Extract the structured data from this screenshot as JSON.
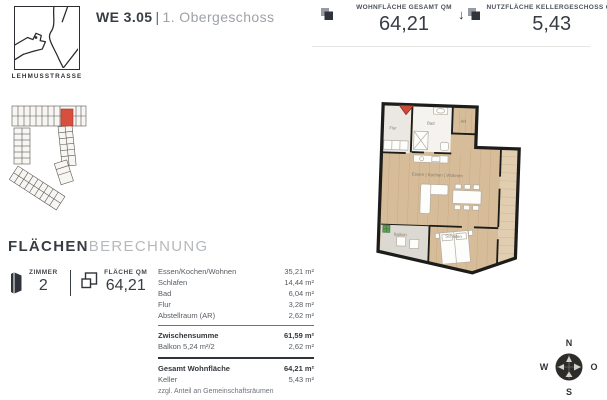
{
  "header": {
    "logo": {
      "caption": "LEHMUSSTRASSE",
      "icon": "street-map-icon"
    },
    "title": {
      "unit": "WE 3.05",
      "divider": "|",
      "floor": "1. Obergeschoss"
    },
    "stats": [
      {
        "icon": "overlapping-squares-icon",
        "label": "WOHNFLÄCHE GESAMT QM",
        "value": "64,21"
      },
      {
        "icon": "overlapping-squares-icon",
        "arrow": "↓",
        "label": "NUTZFLÄCHE KELLERGESCHOSS QM",
        "value": "5,43"
      }
    ]
  },
  "section": {
    "title_bold": "FLÄCHEN",
    "title_light": "BERECHNUNG",
    "zimmer": {
      "icon": "door-icon",
      "label": "ZIMMER",
      "value": "2"
    },
    "flaeche": {
      "icon": "overlapping-squares-icon",
      "label": "FLÄCHE QM",
      "value": "64,21"
    }
  },
  "area_table": {
    "rows": [
      {
        "label": "Essen/Kochen/Wohnen",
        "value": "35,21 m²"
      },
      {
        "label": "Schlafen",
        "value": "14,44 m²"
      },
      {
        "label": "Bad",
        "value": "6,04 m²"
      },
      {
        "label": "Flur",
        "value": "3,28 m²"
      },
      {
        "label": "Abstellraum (AR)",
        "value": "2,62 m²"
      }
    ],
    "subtotal": {
      "label": "Zwischensumme",
      "value": "61,59 m²"
    },
    "balkon": {
      "label": "Balkon 5,24 m²/2",
      "value": "2,62 m²"
    },
    "total": {
      "label": "Gesamt Wohnfläche",
      "value": "64,21 m²"
    },
    "keller": {
      "label": "Keller",
      "value": "5,43 m²"
    },
    "footnote": "zzgl. Anteil an Gemeinschaftsräumen"
  },
  "floorplan": {
    "rooms": {
      "flur": "Flur",
      "bad": "Bad",
      "ar": "AR",
      "wohnen": "Essen | Kochen | Wohnen",
      "schlafen": "Schlafen",
      "balkon": "Balkon"
    },
    "colors": {
      "wood_floor": "#d6bc99",
      "wood_light": "#e1ceb1",
      "wall": "#1c1c1a",
      "bath_tile": "#f5f3ef",
      "hall_floor": "#ebe8e3",
      "balcony_floor": "#dcd9d3",
      "marker_red": "#cc4a38",
      "plant_green": "#5d9e52"
    }
  },
  "site_plan": {
    "name": "building-key-plan",
    "highlight_color": "#d94f3d"
  },
  "compass": {
    "n": "N",
    "o": "O",
    "s": "S",
    "w": "W"
  }
}
